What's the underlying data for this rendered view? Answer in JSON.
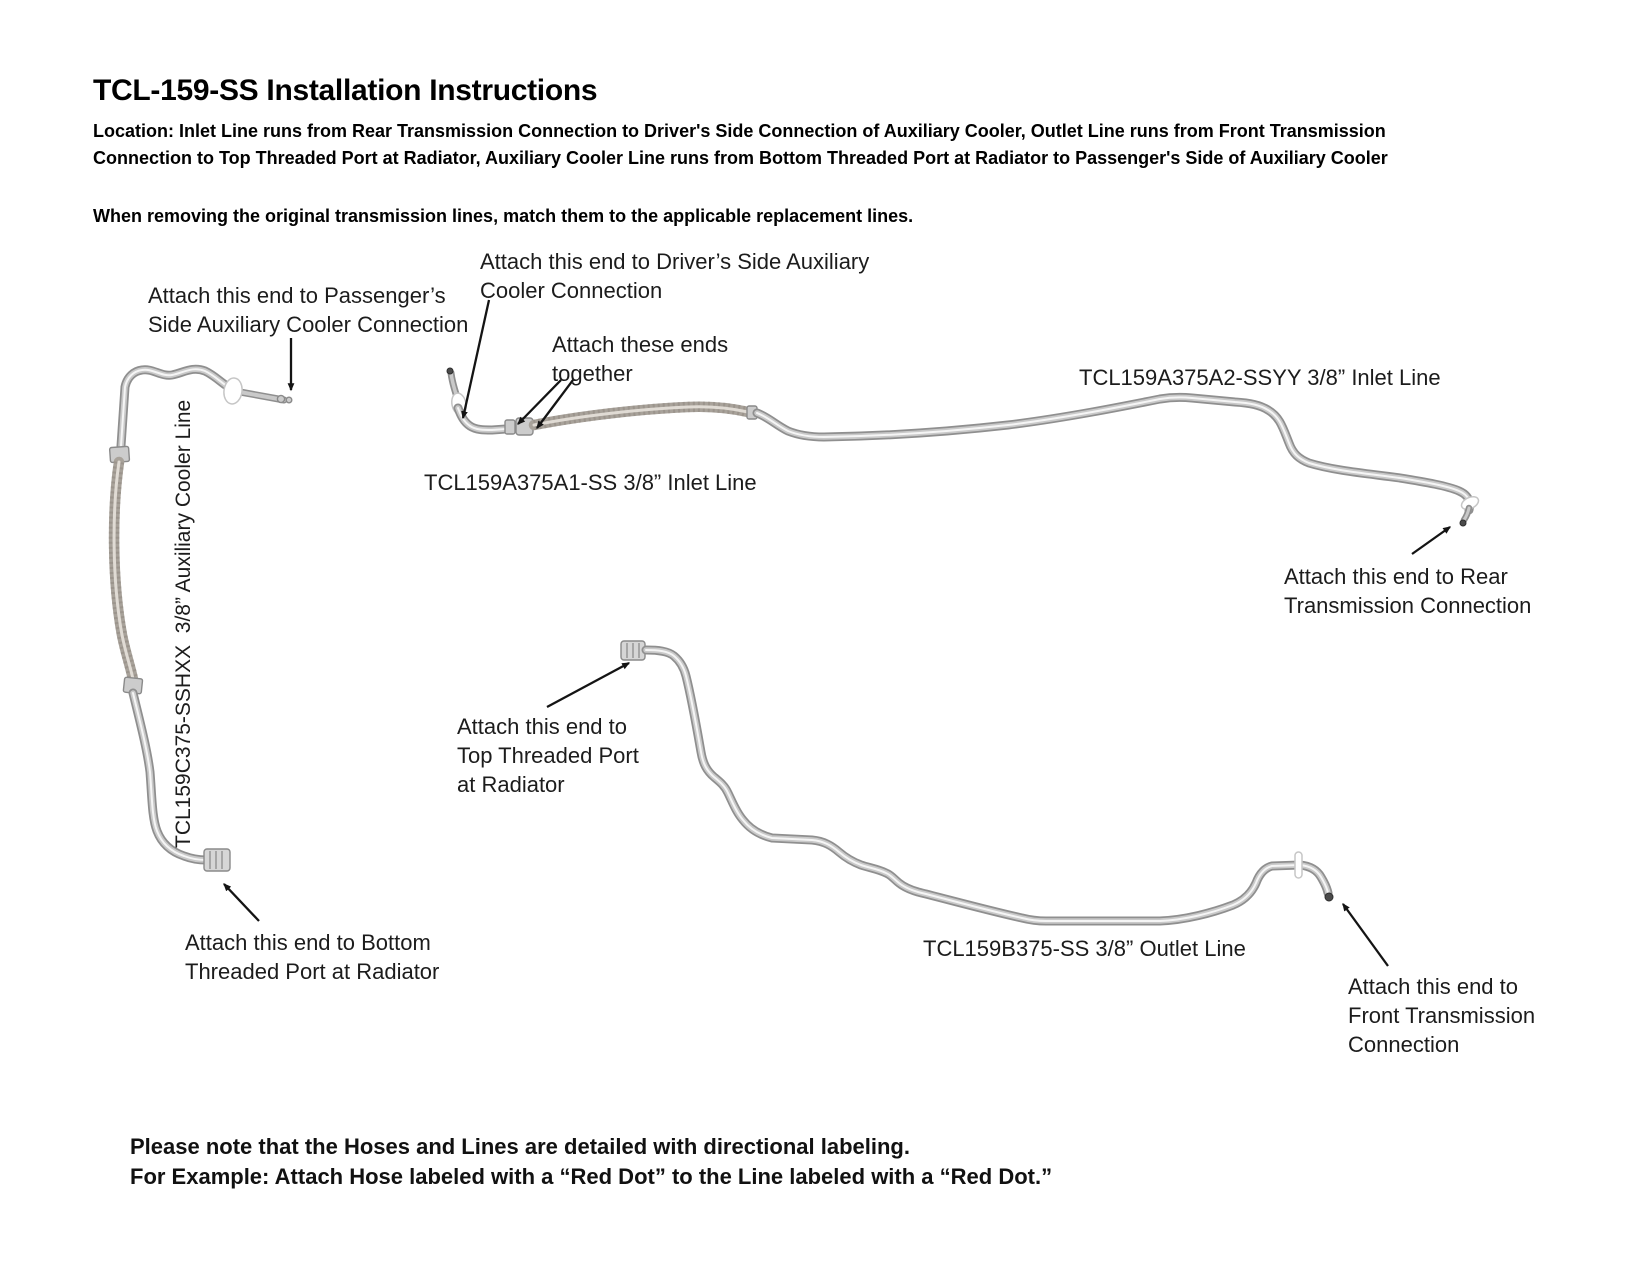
{
  "title": "TCL-159-SS Installation Instructions",
  "location_note": "Location: Inlet Line runs from Rear Transmission Connection to Driver's Side Connection of Auxiliary Cooler, Outlet Line runs from Front Transmission Connection to Top Threaded Port at Radiator, Auxiliary Cooler Line runs from Bottom Threaded Port at Radiator to Passenger's Side of Auxiliary Cooler",
  "removal_note": "When removing the original transmission lines, match them to the applicable replacement lines.",
  "diagram": {
    "labels": {
      "inlet_line_a1": "TCL159A375A1-SS 3/8” Inlet Line",
      "inlet_line_a2": "TCL159A375A2-SSYY 3/8” Inlet Line",
      "outlet_line": "TCL159B375-SS 3/8” Outlet Line",
      "auxiliary_cooler_line": "TCL159C375-SSHXX  3/8” Auxiliary Cooler Line"
    },
    "callouts": {
      "passenger": {
        "line1": "Attach this end to Passenger’s",
        "line2": "Side Auxiliary Cooler Connection"
      },
      "driver": {
        "line1": "Attach this end to Driver’s Side Auxiliary",
        "line2": "Cooler Connection"
      },
      "ends_together": {
        "line1": "Attach these ends",
        "line2": "together"
      },
      "rear_transmission": {
        "line1": "Attach this end to Rear",
        "line2": "Transmission Connection"
      },
      "top_threaded_port": {
        "line1": "Attach this end to",
        "line2": "Top Threaded Port",
        "line3": "at Radiator"
      },
      "bottom_threaded_port": {
        "line1": "Attach this end to Bottom",
        "line2": "Threaded Port at Radiator"
      },
      "front_transmission": {
        "line1": "Attach this end to",
        "line2": "Front Transmission",
        "line3": "Connection"
      }
    }
  },
  "footer_note": {
    "line1": "Please note that the Hoses and Lines are detailed with directional labeling.",
    "line2": "For Example: Attach Hose labeled with a “Red Dot” to the Line labeled with a “Red Dot.”"
  }
}
